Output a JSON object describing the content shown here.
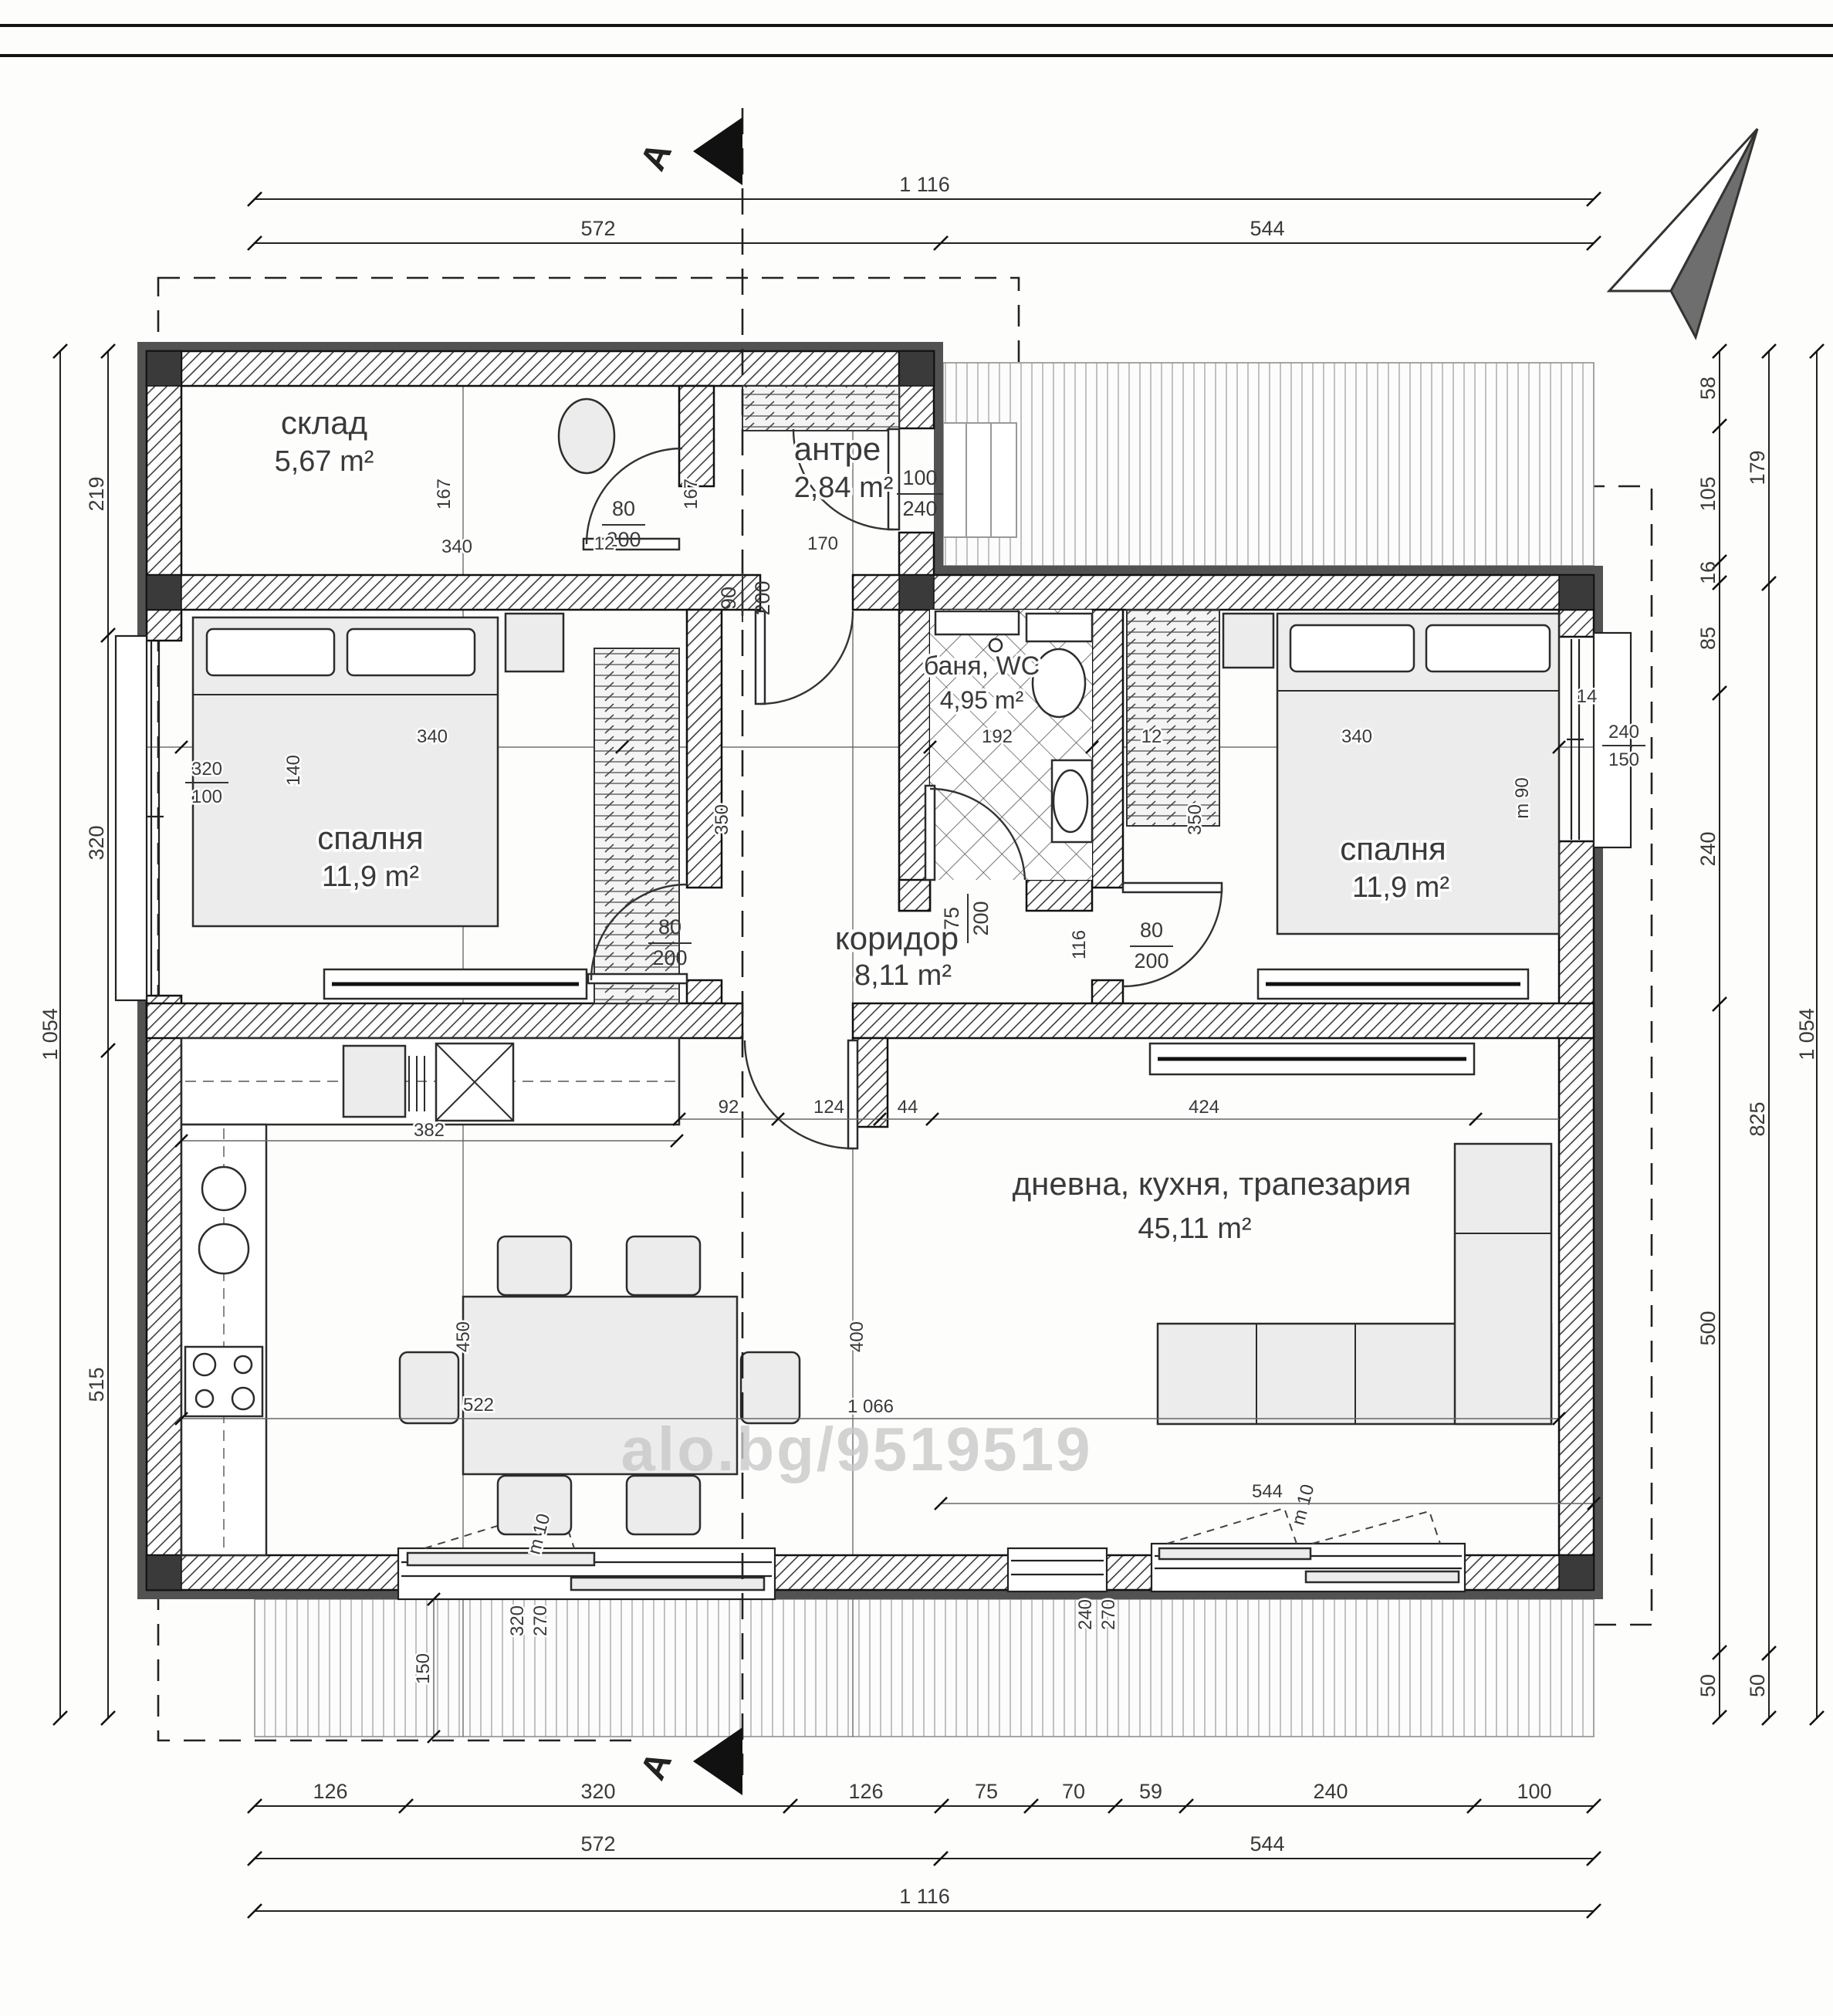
{
  "page": {
    "watermark": "alo.bg/9519519"
  },
  "section": {
    "label_top": "A",
    "label_bottom": "A"
  },
  "rooms": [
    {
      "name": "склад",
      "area": "5,67 m²"
    },
    {
      "name": "антре",
      "area": "2,84 m²"
    },
    {
      "name": "спалня",
      "area": "11,9 m²"
    },
    {
      "name": "баня, WC",
      "area": "4,95 m²"
    },
    {
      "name": "коридор",
      "area": "8,11 m²"
    },
    {
      "name": "спалня",
      "area": "11,9 m²"
    },
    {
      "name": "дневна, кухня, трапезария",
      "area": "45,11 m²"
    }
  ],
  "doors": {
    "storage": {
      "w": "80",
      "h": "200"
    },
    "entry": {
      "w": "100",
      "h": "240"
    },
    "hall": {
      "w": "90",
      "h": "200"
    },
    "bedroom_left": {
      "w": "80",
      "h": "200"
    },
    "bedroom_right": {
      "w": "80",
      "h": "200"
    },
    "bath": {
      "w": "75",
      "h": "200"
    }
  },
  "windows": {
    "left": {
      "w": "320",
      "h": "100",
      "sill": "140"
    },
    "right": {
      "w": "240",
      "h": "150",
      "sill": "m 90",
      "offset": "14"
    },
    "bottom_left": {
      "w": "320",
      "h": "270",
      "mark": "m 10"
    },
    "bottom_right": {
      "w": "240",
      "h": "270",
      "mark": "m 10"
    }
  },
  "dims": {
    "top": {
      "total": "1 116",
      "segments": [
        "572",
        "544"
      ]
    },
    "bottom": {
      "row1": [
        "126",
        "320",
        "126",
        "75",
        "70",
        "59",
        "240",
        "100"
      ],
      "row2": [
        "572",
        "544"
      ],
      "total": "1 116"
    },
    "left": {
      "outer": "1 054",
      "inner": [
        "219",
        "320",
        "515"
      ]
    },
    "right": {
      "inner": [
        "58",
        "105",
        "16",
        "85",
        "240",
        "500",
        "50"
      ],
      "middle": [
        "179",
        "825",
        "50"
      ],
      "outer": "1 054"
    },
    "interior": {
      "storage_h": "167",
      "storage_w": "340",
      "p12a": "12",
      "hall_w": "170",
      "entry_h": "167",
      "bed_left_w": "340",
      "bath_w": "192",
      "p12b": "12",
      "bed_right_w": "340",
      "bed_left_d": "350",
      "bed_right_d": "350",
      "corridor_w": "116",
      "counter": "382",
      "seg92": "92",
      "seg124": "124",
      "seg44": "44",
      "seg424": "424",
      "kitchen_d": "450",
      "living_d": "400",
      "living_w": "1 066",
      "win522": "522",
      "win544": "544",
      "deck_d": "150"
    }
  }
}
